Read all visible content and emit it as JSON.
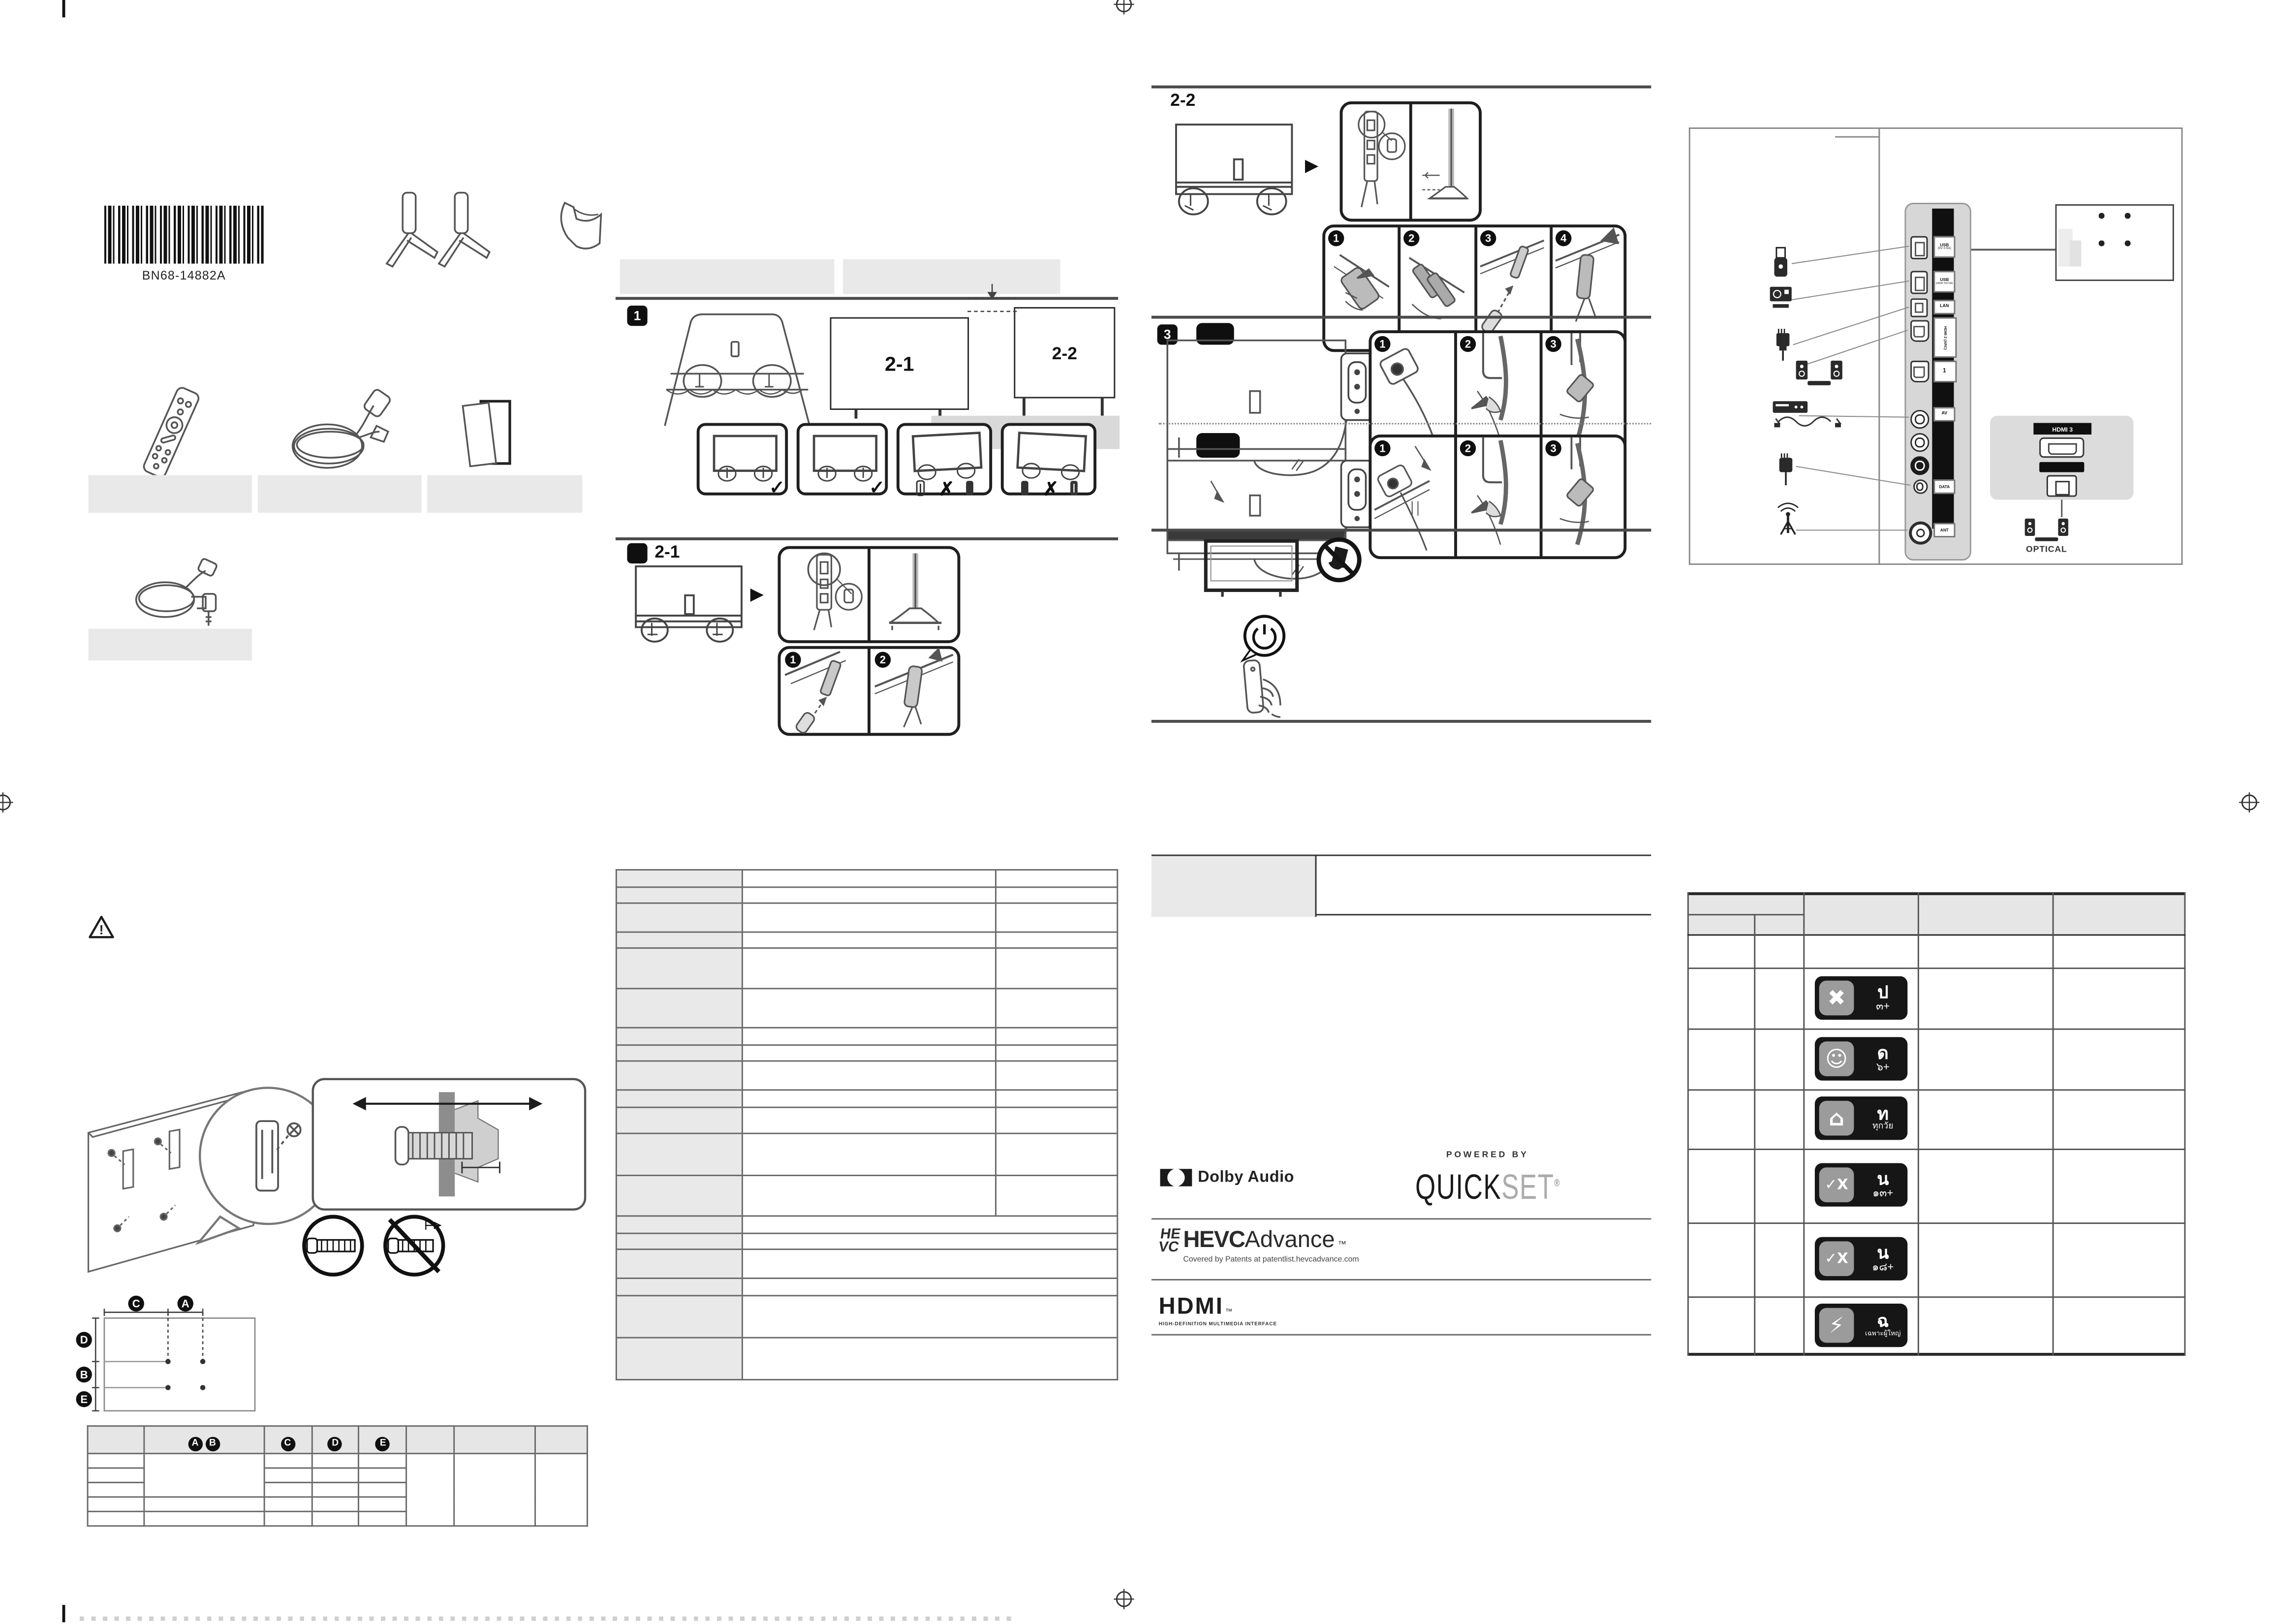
{
  "doc": {
    "kind": "tv-quick-setup-guide-sheet"
  },
  "barcode": {
    "label": "BN68-14882A"
  },
  "sections": {
    "s1": "1",
    "s21": "2-1",
    "s22": "2-2",
    "s3": "3"
  },
  "steps": {
    "n1": "1",
    "n2": "2",
    "n3": "3",
    "n4": "4"
  },
  "glyphs": {
    "arrow_right": "▶",
    "check": "✓",
    "cross": "✗",
    "warning": "!"
  },
  "vesa": {
    "a": "A",
    "b": "B",
    "c": "C",
    "d": "D",
    "e": "E"
  },
  "ports": {
    "usb1_l1": "USB",
    "usb1_l2": "(5V 0.5A)",
    "usb2_l1": "USB",
    "usb2_l2": "(HDD 5V/1A)",
    "lan": "LAN",
    "hdmi2": "HDMI 2 (ARC)",
    "hdmi1": "1",
    "av": "AV",
    "data": "DATA",
    "ant": "ANT",
    "hdmi3": "HDMI 3",
    "optical": "OPTICAL"
  },
  "logos": {
    "dolby": "Dolby Audio",
    "powered_by": "POWERED BY",
    "quick": "QUICK",
    "set": "SET",
    "registered": "®",
    "hevc_mark_top": "HE",
    "hevc_mark_bottom": "VC",
    "hevc": "HEVC",
    "advance": "Advance",
    "tm": "™",
    "hevc_tagline": "Covered by Patents at patentlist.hevcadvance.com",
    "hdmi": "HDMI",
    "hdmi_tagline": "HIGH-DEFINITION MULTIMEDIA INTERFACE"
  },
  "rating": {
    "rows": [
      {
        "letter": "ป",
        "age": "๓+",
        "symbol": "✖"
      },
      {
        "letter": "ด",
        "age": "๖+",
        "symbol": "☺"
      },
      {
        "letter": "ท",
        "age": "ทุกวัย",
        "symbol": "⌂"
      },
      {
        "letter": "น",
        "age": "๑๓+",
        "symbol": "✓X"
      },
      {
        "letter": "น",
        "age": "๑๘+",
        "symbol": "✓X"
      },
      {
        "letter": "ฉ",
        "age": "เฉพาะผู้ใหญ่",
        "symbol": "⚡"
      }
    ]
  },
  "colors": {
    "band_gray": "#e9e9e9",
    "table_header_gray": "#e6e6e6",
    "panel_gray": "#d7d7d7",
    "badge_dark": "#161616",
    "badge_gray": "#9b9b9b",
    "set_gray": "#ababab"
  }
}
